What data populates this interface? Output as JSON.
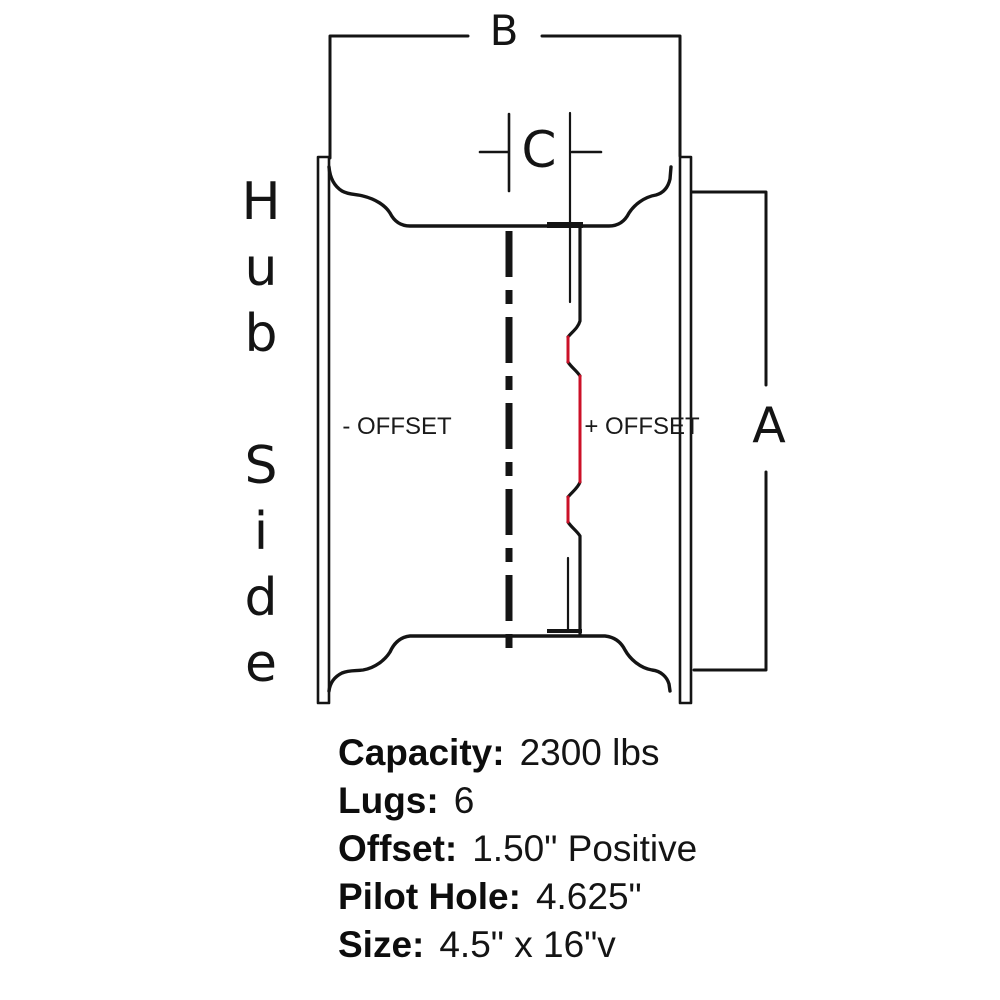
{
  "diagram": {
    "hub_side_label": "Hub Side",
    "dim_b_label": "B",
    "dim_c_label": "C",
    "dim_a_label": "A",
    "negative_offset_label": "- OFFSET",
    "positive_offset_label": "+ OFFSET",
    "colors": {
      "line": "#141414",
      "mounting_face_highlight": "#cc1128"
    }
  },
  "specs": {
    "rows": [
      {
        "label": "Capacity:",
        "value": "2300 lbs"
      },
      {
        "label": "Lugs:",
        "value": "6"
      },
      {
        "label": "Offset:",
        "value": "1.50\" Positive"
      },
      {
        "label": "Pilot Hole:",
        "value": "4.625\""
      },
      {
        "label": "Size:",
        "value": "4.5\" x 16\"v"
      }
    ]
  }
}
